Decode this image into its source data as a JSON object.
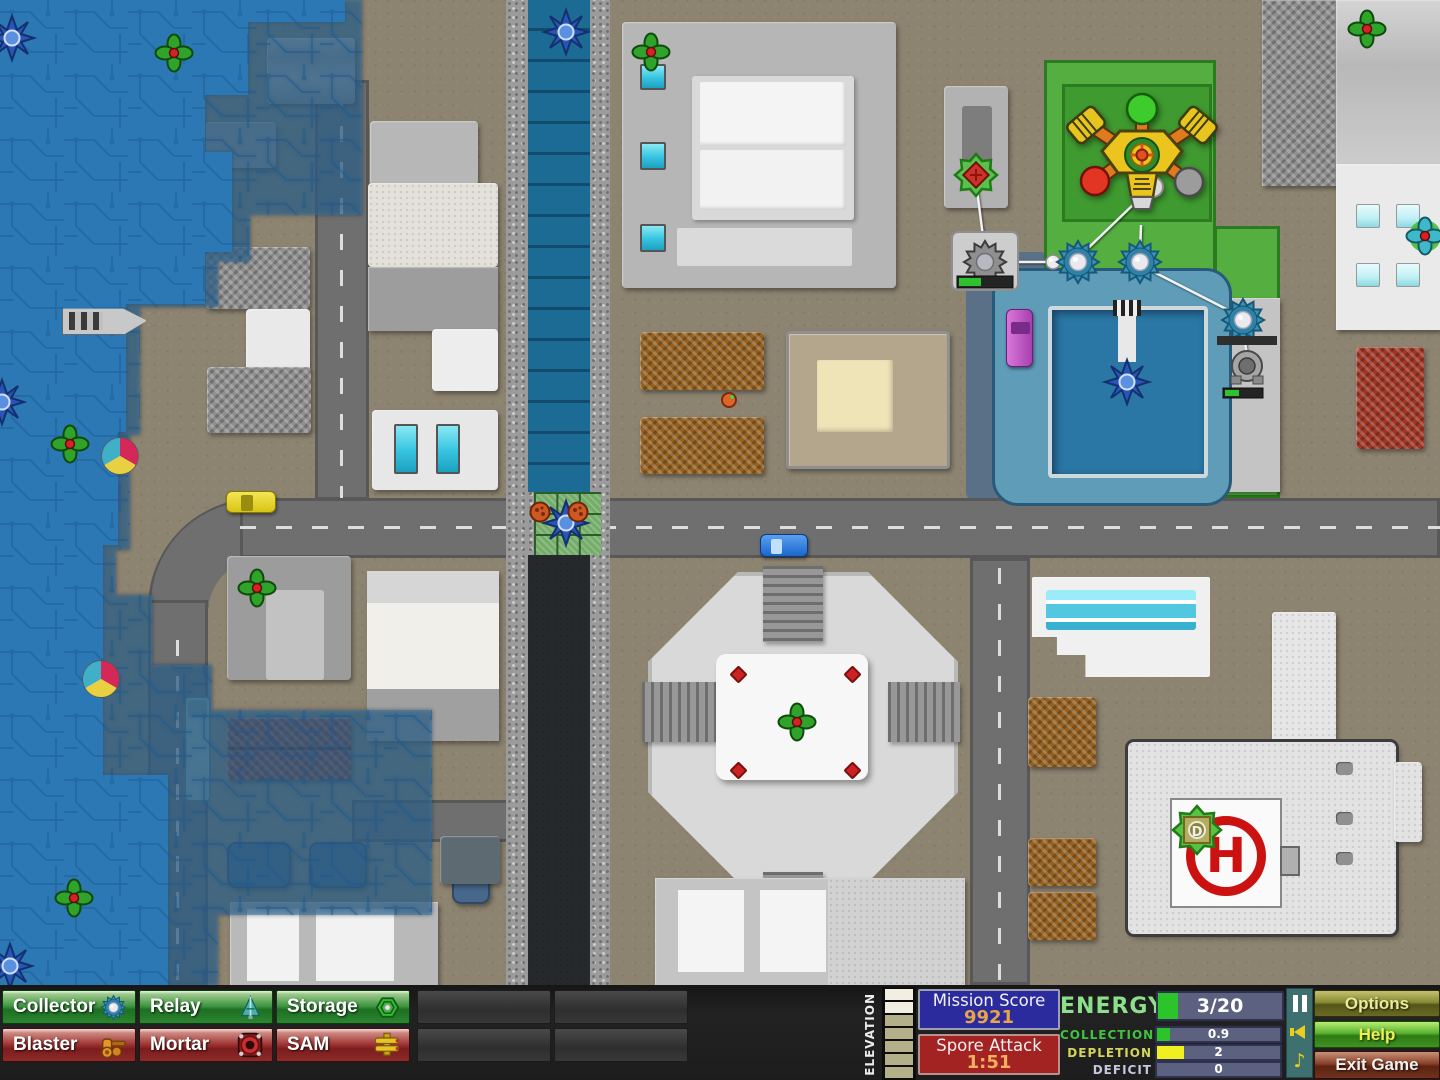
{
  "title": "Creeper World - city defense mission",
  "colors": {
    "creeper_deep": "#2b78b4",
    "creeper_shallow": "rgba(58,118,160,0.55)",
    "energy_fill": "#2bc42b",
    "depletion_fill": "#f0f020",
    "panel_blue": "#2b2b9e",
    "panel_red": "#a32222",
    "hud_green_button": "#2b8631",
    "hud_red_button": "#8e2a2a"
  },
  "map": {
    "helipad_label": "H",
    "pickup_label": "D",
    "markers": [
      {
        "type": "spore",
        "x": 12,
        "y": 38
      },
      {
        "type": "spore",
        "x": 2,
        "y": 402
      },
      {
        "type": "spore",
        "x": 10,
        "y": 966
      },
      {
        "type": "spore",
        "x": 566,
        "y": 32
      },
      {
        "type": "spore",
        "x": 566,
        "y": 523
      },
      {
        "type": "spore",
        "x": 1127,
        "y": 382
      },
      {
        "type": "flower",
        "x": 174,
        "y": 53
      },
      {
        "type": "flower",
        "x": 70,
        "y": 444
      },
      {
        "type": "flower",
        "x": 257,
        "y": 588
      },
      {
        "type": "flower",
        "x": 74,
        "y": 898
      },
      {
        "type": "flower",
        "x": 651,
        "y": 52
      },
      {
        "type": "flower",
        "x": 1367,
        "y": 29
      },
      {
        "type": "flower",
        "x": 797,
        "y": 722
      },
      {
        "type": "flower-cyan",
        "x": 1425,
        "y": 236
      },
      {
        "type": "gear-red",
        "x": 976,
        "y": 175
      },
      {
        "type": "beachball",
        "x": 120,
        "y": 456
      },
      {
        "type": "beachball",
        "x": 101,
        "y": 679
      },
      {
        "type": "pod",
        "x": 540,
        "y": 512
      },
      {
        "type": "pod",
        "x": 578,
        "y": 512
      },
      {
        "type": "pod-small",
        "x": 729,
        "y": 400
      },
      {
        "type": "node",
        "x": 1053,
        "y": 262
      },
      {
        "type": "collector",
        "x": 1078,
        "y": 262
      },
      {
        "type": "collector",
        "x": 1140,
        "y": 262
      },
      {
        "type": "collector",
        "x": 1243,
        "y": 320
      },
      {
        "type": "collector-gray",
        "x": 985,
        "y": 262
      },
      {
        "type": "mortar-gray",
        "x": 1247,
        "y": 368
      },
      {
        "type": "pickup",
        "x": 1197,
        "y": 830
      }
    ]
  },
  "hud": {
    "elevation_label": "ELEVATION",
    "build_buttons": [
      {
        "label": "Collector",
        "icon": "collector-icon"
      },
      {
        "label": "Relay",
        "icon": "relay-icon"
      },
      {
        "label": "Storage",
        "icon": "storage-icon"
      },
      {
        "label": "Blaster",
        "icon": "blaster-icon"
      },
      {
        "label": "Mortar",
        "icon": "mortar-icon"
      },
      {
        "label": "SAM",
        "icon": "sam-icon"
      }
    ],
    "panels": {
      "mission_score": {
        "title": "Mission Score",
        "value": "9921"
      },
      "spore_attack": {
        "title": "Spore Attack",
        "value": "1:51"
      }
    },
    "energy": {
      "label": "ENERGY",
      "value": "3/20",
      "rows": [
        {
          "label": "COLLECTION",
          "value": "0.9"
        },
        {
          "label": "DEPLETION",
          "value": "2"
        },
        {
          "label": "DEFICIT",
          "value": "0"
        }
      ]
    },
    "av_controls": [
      {
        "icon": "pause-icon"
      },
      {
        "icon": "speaker-icon"
      },
      {
        "icon": "music-note-icon"
      }
    ],
    "system_buttons": [
      {
        "label": "Options"
      },
      {
        "label": "Help"
      },
      {
        "label": "Exit Game"
      }
    ]
  }
}
